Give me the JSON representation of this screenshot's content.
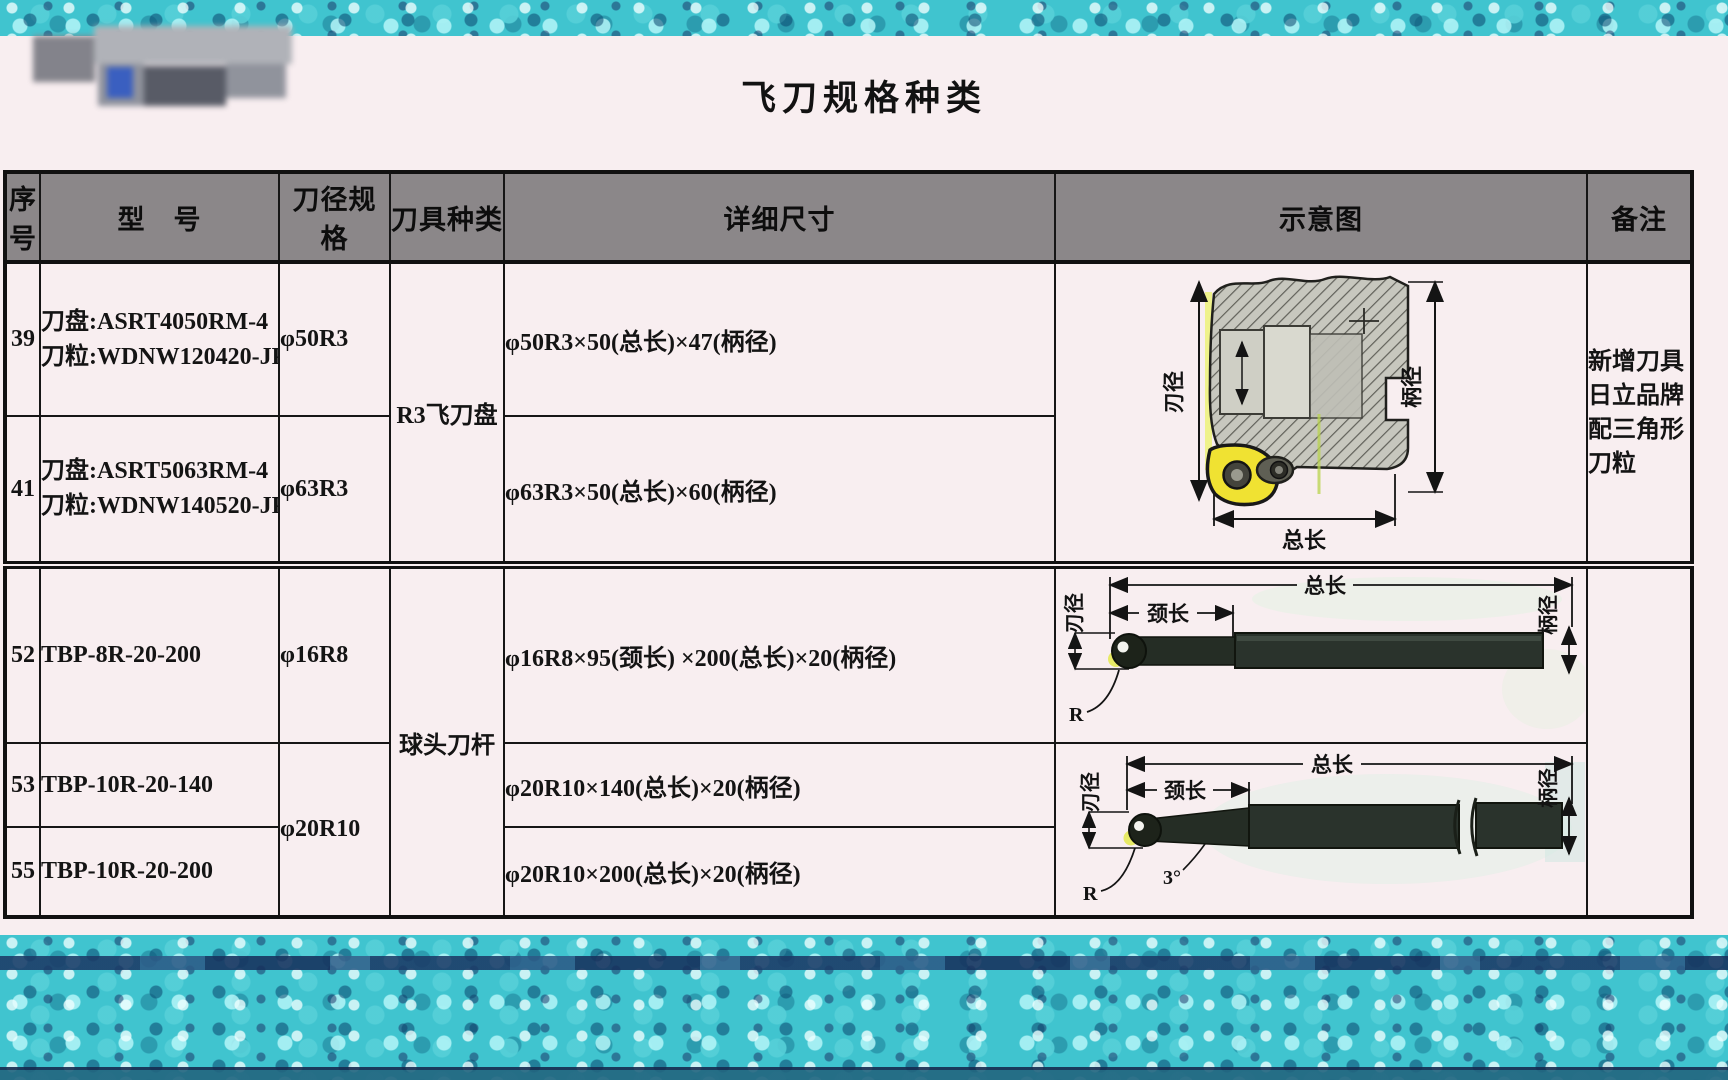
{
  "page": {
    "title": "飞刀规格种类"
  },
  "table": {
    "headers": [
      "序号",
      "型　号",
      "刀径规格",
      "刀具种类",
      "详细尺寸",
      "示意图",
      "备注"
    ],
    "rows": [
      {
        "no": "39",
        "model_line1": "刀盘:ASRT4050RM-4",
        "model_line2": "刀粒:WDNW120420-JP4020",
        "diameter": "φ50R3",
        "dimensions": "φ50R3×50(总长)×47(柄径)"
      },
      {
        "no": "41",
        "model_line1": "刀盘:ASRT5063RM-4",
        "model_line2": "刀粒:WDNW140520-JP4020",
        "diameter": "φ63R3",
        "dimensions": "φ63R3×50(总长)×60(柄径)"
      },
      {
        "no": "52",
        "model_line1": "TBP-8R-20-200",
        "diameter": "φ16R8",
        "dimensions": "φ16R8×95(颈长) ×200(总长)×20(柄径)"
      },
      {
        "no": "53",
        "model_line1": "TBP-10R-20-140",
        "diameter": "φ20R10",
        "dimensions": "φ20R10×140(总长)×20(柄径)"
      },
      {
        "no": "55",
        "model_line1": "TBP-10R-20-200",
        "dimensions": "φ20R10×200(总长)×20(柄径)"
      }
    ],
    "tool_types": {
      "r3_fly_cutter": "R3飞刀盘",
      "ball_nose_bar": "球头刀杆"
    },
    "remark": {
      "lines": [
        "新增刀具",
        "日立品牌",
        "配三角形",
        "刀粒"
      ]
    }
  },
  "diagrams": {
    "fly_cutter": {
      "labels": {
        "blade_diameter": "刃径",
        "shank_diameter": "柄径",
        "total_length": "总长"
      }
    },
    "ball_bar": {
      "labels": {
        "blade_diameter": "刃径",
        "shank_diameter": "柄径",
        "total_length": "总长",
        "neck_length": "颈长",
        "radius": "R",
        "taper_angle": "3°"
      }
    }
  },
  "colors": {
    "page_bg": "#f8eef0",
    "header_bg": "#8b8789",
    "table_border": "#161616",
    "teal_band": "#40c4cf",
    "navy_stripe": "#1b3a66",
    "insert_yellow": "#f0e232",
    "bar_dark": "#2a332c",
    "hatch_gray": "#c7c7be"
  }
}
